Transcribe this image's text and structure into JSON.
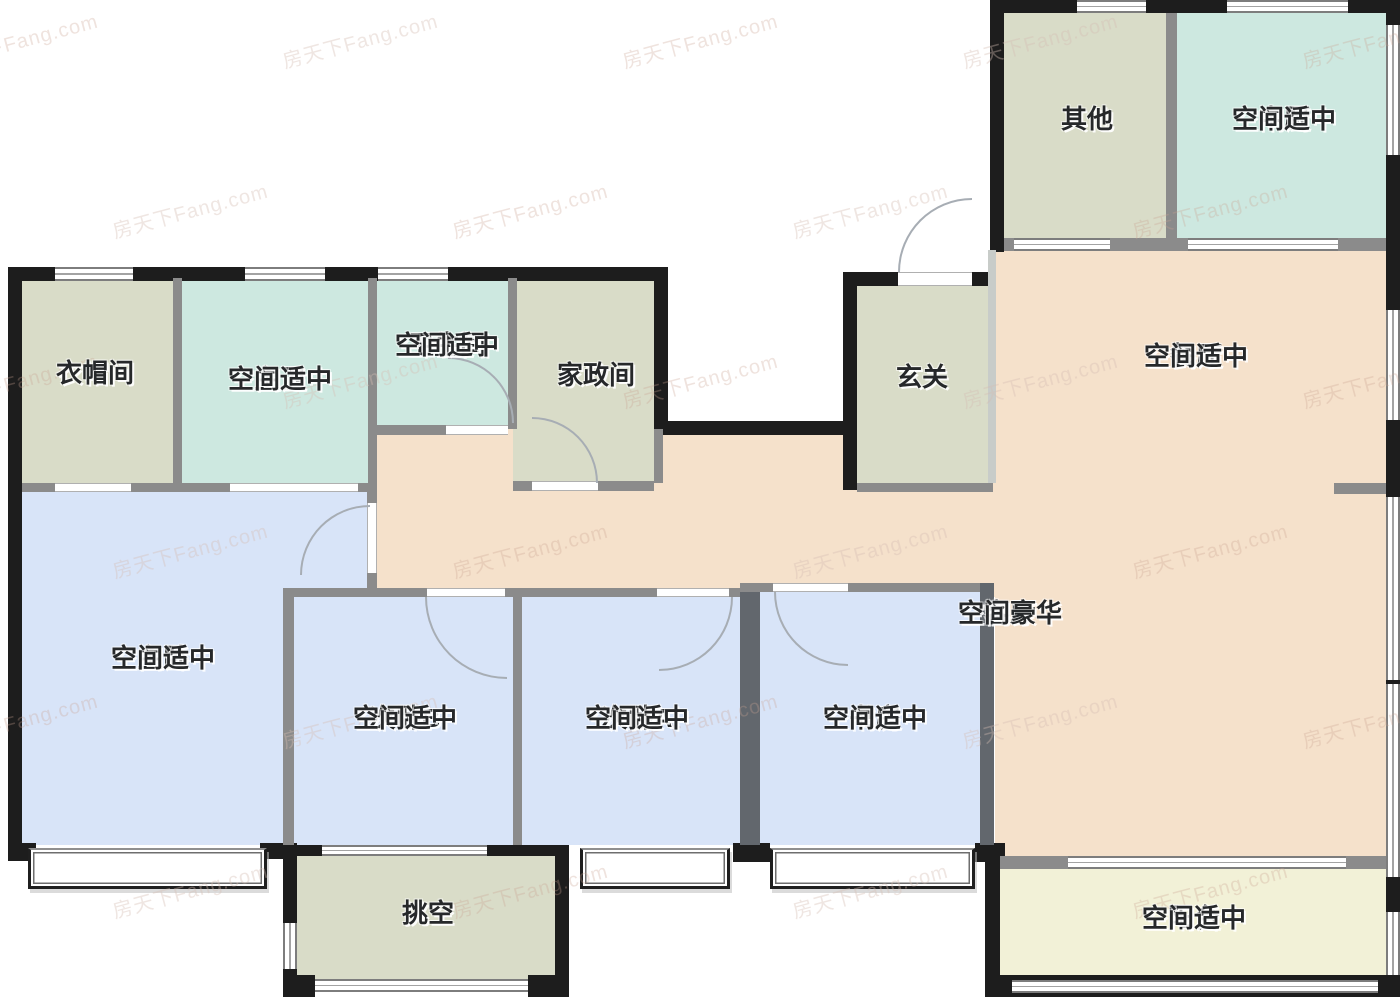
{
  "watermark": {
    "text": "房天下Fang.com"
  },
  "rooms": [
    {
      "id": "other",
      "name": "其他",
      "note": ""
    },
    {
      "id": "kitchen",
      "name": "中厨",
      "note": "空间适中"
    },
    {
      "id": "cloakroom",
      "name": "衣帽间",
      "note": ""
    },
    {
      "id": "master-bath",
      "name": "主卫",
      "note": "空间适中"
    },
    {
      "id": "bathroom",
      "name": "卫生间",
      "note": "空间适中"
    },
    {
      "id": "laundry",
      "name": "家政间",
      "note": ""
    },
    {
      "id": "foyer",
      "name": "玄关",
      "note": ""
    },
    {
      "id": "dining",
      "name": "餐厅",
      "note": "空间适中"
    },
    {
      "id": "master-bedroom",
      "name": "主卧",
      "note": "空间适中"
    },
    {
      "id": "bedroom-b",
      "name": "次卧B",
      "note": "空间适中"
    },
    {
      "id": "bedroom-a",
      "name": "次卧A",
      "note": "空间适中"
    },
    {
      "id": "study",
      "name": "书房",
      "note": "空间适中"
    },
    {
      "id": "living",
      "name": "客厅",
      "note": "空间豪华"
    },
    {
      "id": "void",
      "name": "挑空",
      "note": ""
    },
    {
      "id": "balcony",
      "name": "阳台",
      "note": "空间适中"
    }
  ],
  "colors": {
    "olive": "#d9dcc8",
    "teal": "#cde8e0",
    "blue": "#d8e4f8",
    "peach": "#f5e1cb",
    "cream": "#f2f1d7",
    "wall-dark": "#1d1d1d",
    "wall-gray": "#8b8b8b",
    "wall-mid": "#62676d",
    "text": "#26282a"
  }
}
